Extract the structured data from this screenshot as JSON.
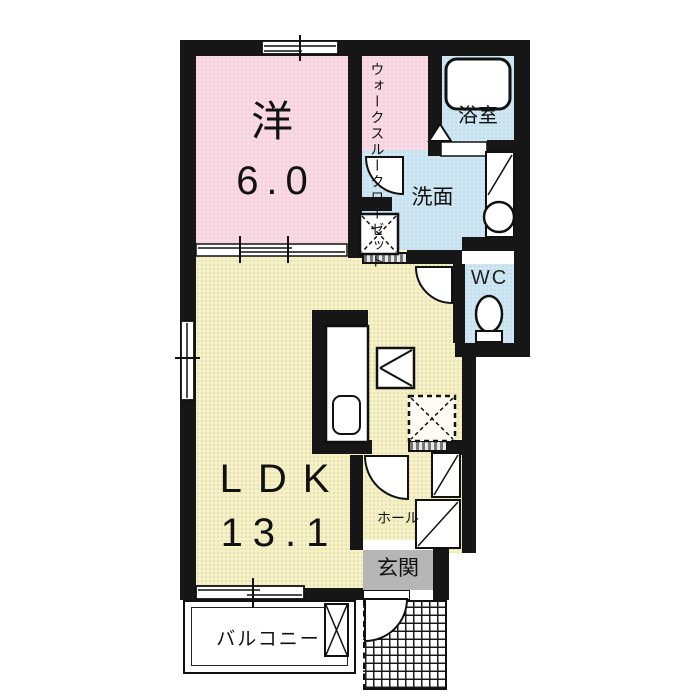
{
  "plan": {
    "title": "apartment floor plan 1LDK",
    "rooms": {
      "western": {
        "label": "洋",
        "area": "6.0"
      },
      "closet": {
        "line1": "ウォークスルー",
        "line2": "クローゼット"
      },
      "bath": {
        "label": "浴室"
      },
      "washroom": {
        "label": "洗面"
      },
      "wc": {
        "label": "WC"
      },
      "ldk": {
        "label": "LDK",
        "area": "13.1"
      },
      "hall": {
        "label": "ホール"
      },
      "entrance": {
        "label": "玄関"
      },
      "balcony": {
        "label": "バルコニー"
      }
    },
    "colors": {
      "wall": "#161616",
      "bedroom_pink": "#f8d9e4",
      "ldk_yellow": "#f5f0c6",
      "wet_area_blue": "#cfe7f2",
      "entrance_gray": "#b6b6b6"
    },
    "fixtures": [
      "bathtub",
      "folding-bath-door",
      "washbasin",
      "washing-machine-space",
      "toilet",
      "kitchen-counter",
      "kitchen-sink",
      "refrigerator-space",
      "storage-space",
      "shoe-cabinet",
      "ac-outdoor-unit",
      "tiled-porch",
      "sliding-doors",
      "windows",
      "hinged-doors"
    ]
  }
}
